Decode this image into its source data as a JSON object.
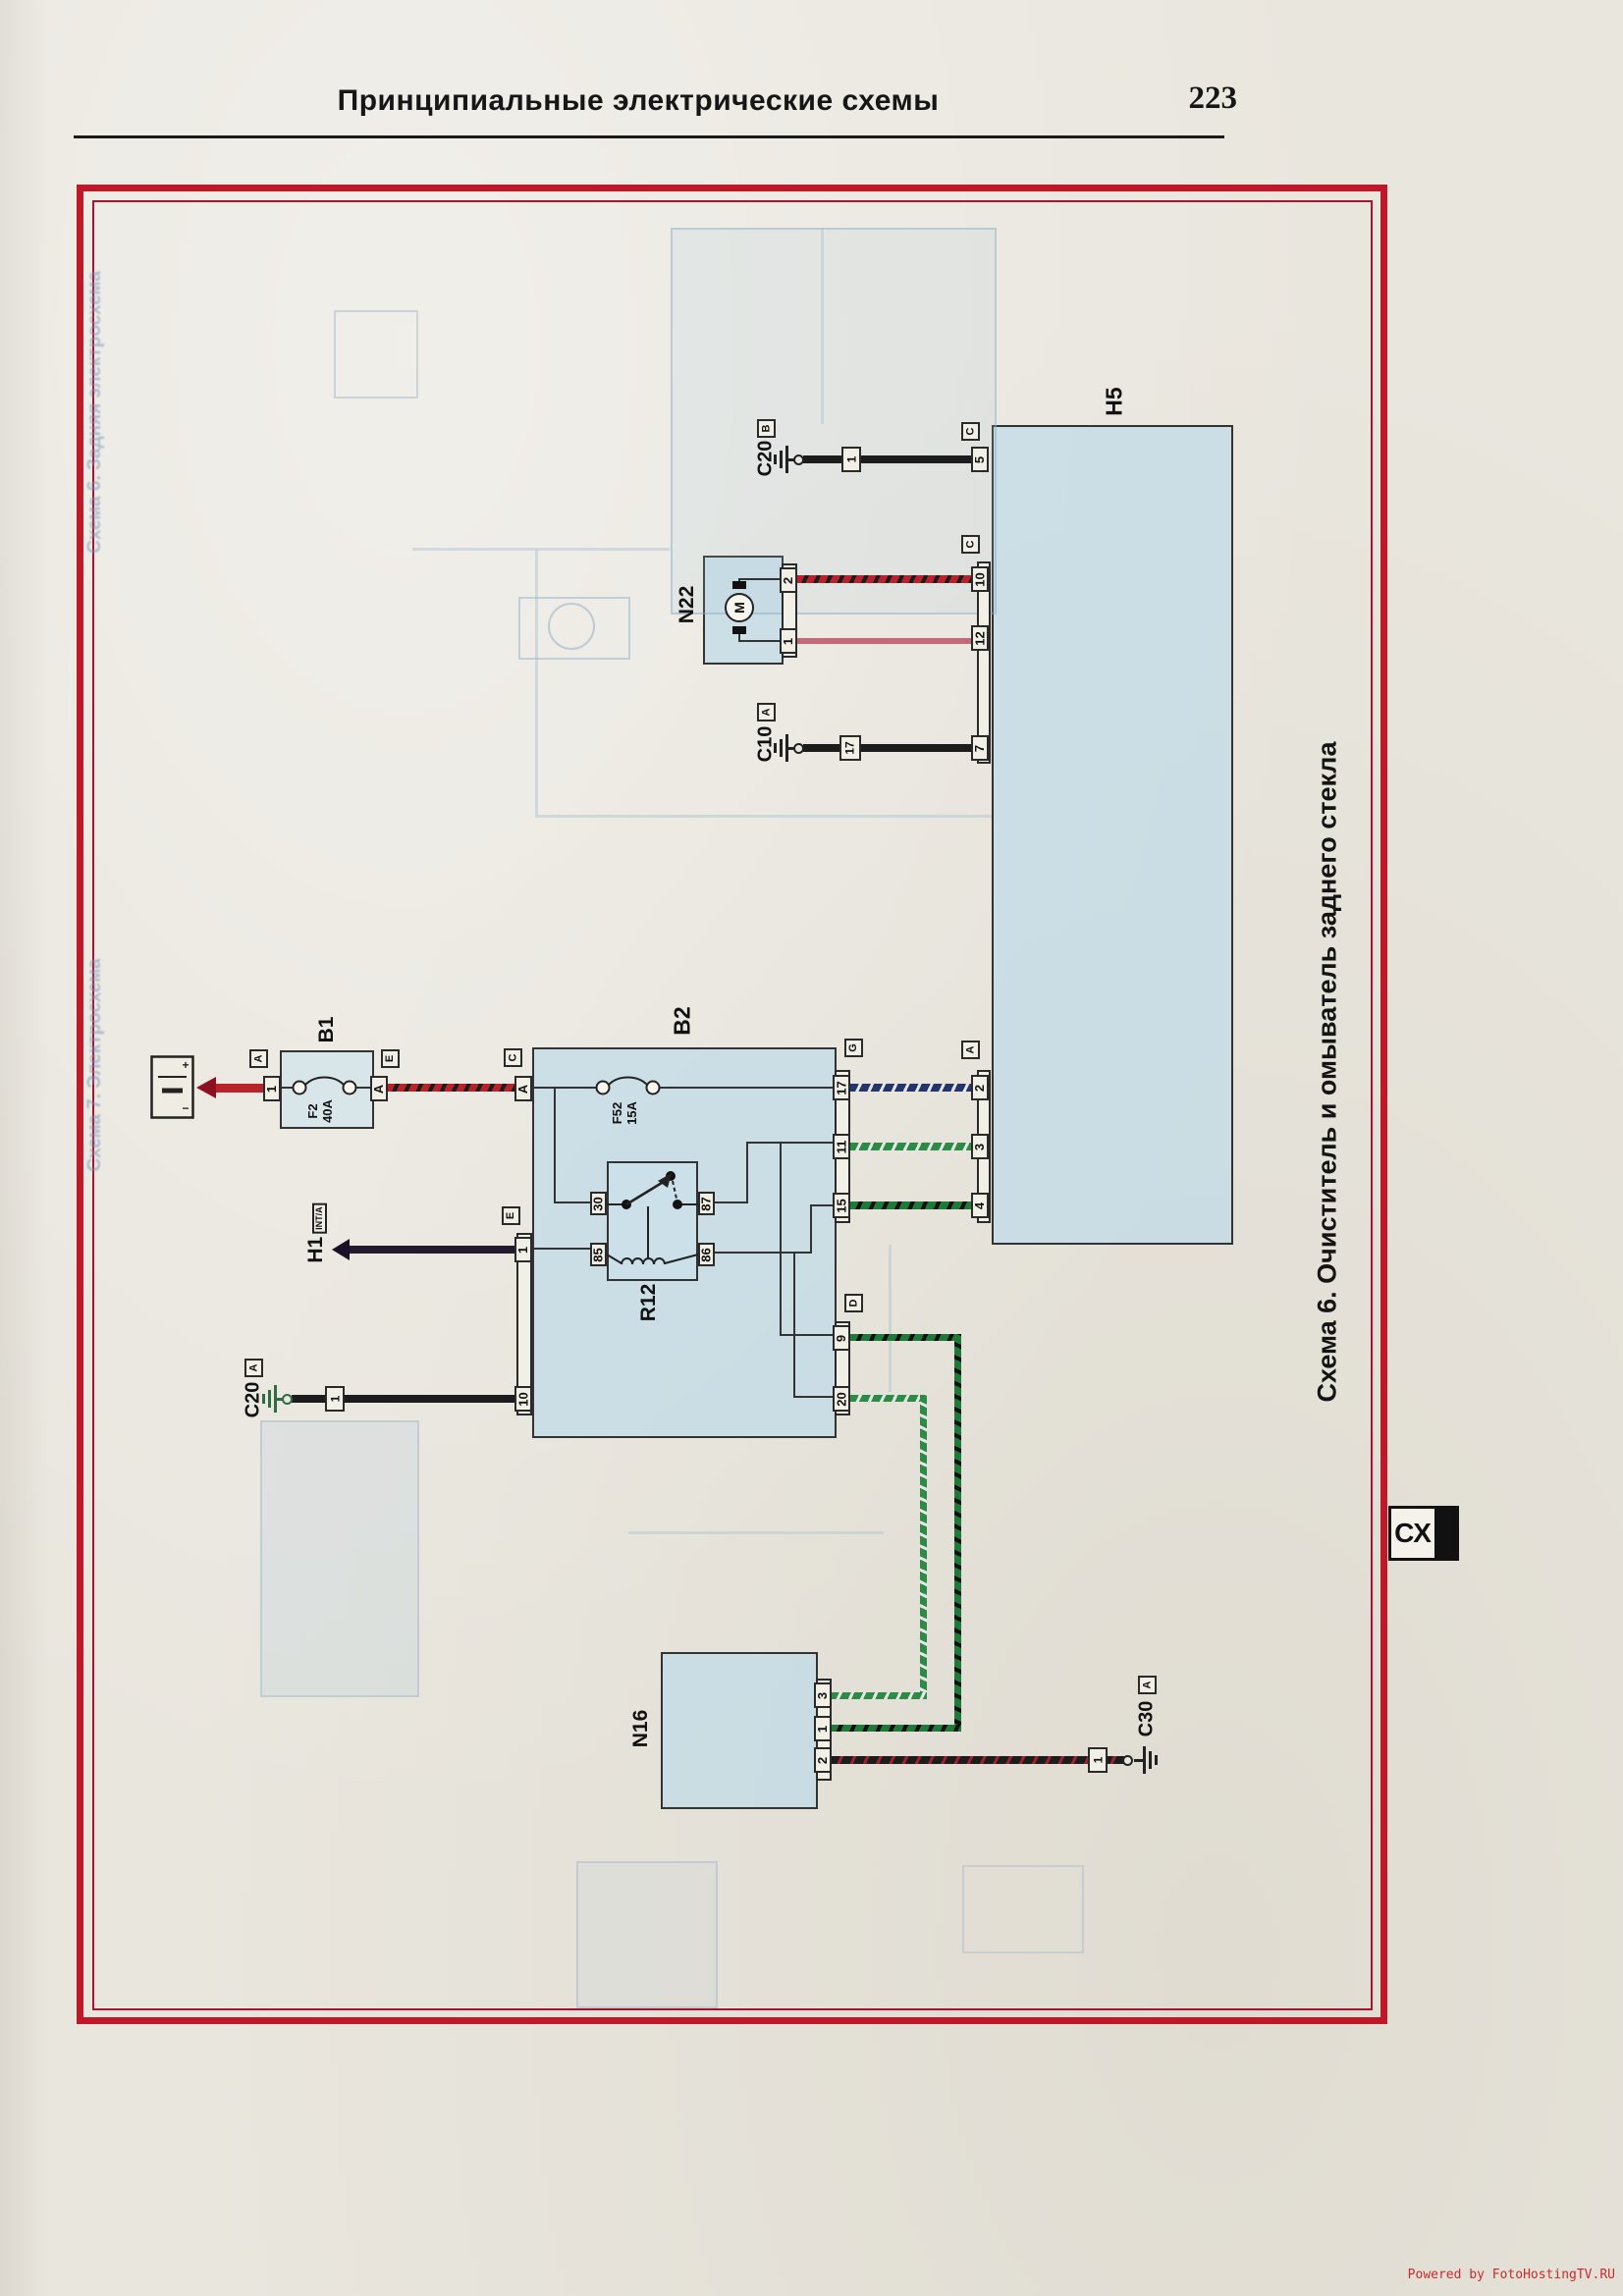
{
  "page": {
    "header_title": "Принципиальные электрические схемы",
    "page_number": "223",
    "caption": "Схема 6. Очиститель и омыватель заднего стекла",
    "tab_label": "СХ",
    "watermark": "Powered by FotoHostingTV.RU"
  },
  "components": {
    "h5": {
      "label": "H5"
    },
    "b1": {
      "label": "B1",
      "fuse_name": "F2",
      "fuse_rating": "40A",
      "pin_left": "1",
      "pin_right": "A",
      "conn_left": "A",
      "conn_right": "E"
    },
    "b2": {
      "label": "B2",
      "fuse_name": "F52",
      "fuse_rating": "15A",
      "conn_left_top": "C",
      "pin_a": "A",
      "conn_left_mid": "E",
      "pin_1": "1",
      "pin_10": "10",
      "conn_right_g": "G",
      "pin_17": "17",
      "pin_11": "11",
      "pin_15": "15",
      "conn_right_d": "D",
      "pin_9": "9",
      "pin_20": "20"
    },
    "r12": {
      "label": "R12",
      "pin_30": "30",
      "pin_87": "87",
      "pin_85": "85",
      "pin_86": "86"
    },
    "n22": {
      "label": "N22",
      "pin_2": "2",
      "pin_1": "1",
      "motor": "M"
    },
    "n16": {
      "label": "N16",
      "pin_3": "3",
      "pin_1": "1",
      "pin_2": "2"
    },
    "h1": {
      "label": "H1",
      "sublabel": "INT/A"
    },
    "battery": {
      "plus": "+",
      "minus": "−"
    },
    "h5_connectors": {
      "top_letter": "C",
      "top_pin": "5",
      "mid_letter": "C",
      "mid_pins": [
        "10",
        "12",
        "7"
      ],
      "low_letter": "A",
      "low_pins": [
        "2",
        "3",
        "4"
      ]
    }
  },
  "grounds": {
    "c20b": {
      "label": "C20",
      "letter": "B",
      "wire_pin": "1"
    },
    "c10a": {
      "label": "C10",
      "letter": "A",
      "wire_pin": "17"
    },
    "c20a": {
      "label": "C20",
      "letter": "A",
      "wire_pin": "1"
    },
    "c30a": {
      "label": "C30",
      "letter": "A",
      "wire_pin": "1"
    }
  },
  "ghost": {
    "caption_top": "Схема 6. Задняя электросхема",
    "caption_bottom": "Схема 7. Электросхема"
  },
  "colors": {
    "frame_red": "#c01828",
    "box_fill": "#d7e5ec",
    "wire_black": "#1c1c1c",
    "wire_red": "#b8222a",
    "wire_pink": "#c4697a",
    "wire_navy": "#25356b",
    "wire_green": "#2e8b47",
    "wire_dark_green": "#1f7a3a",
    "watermark_red": "#cc2a2a"
  }
}
